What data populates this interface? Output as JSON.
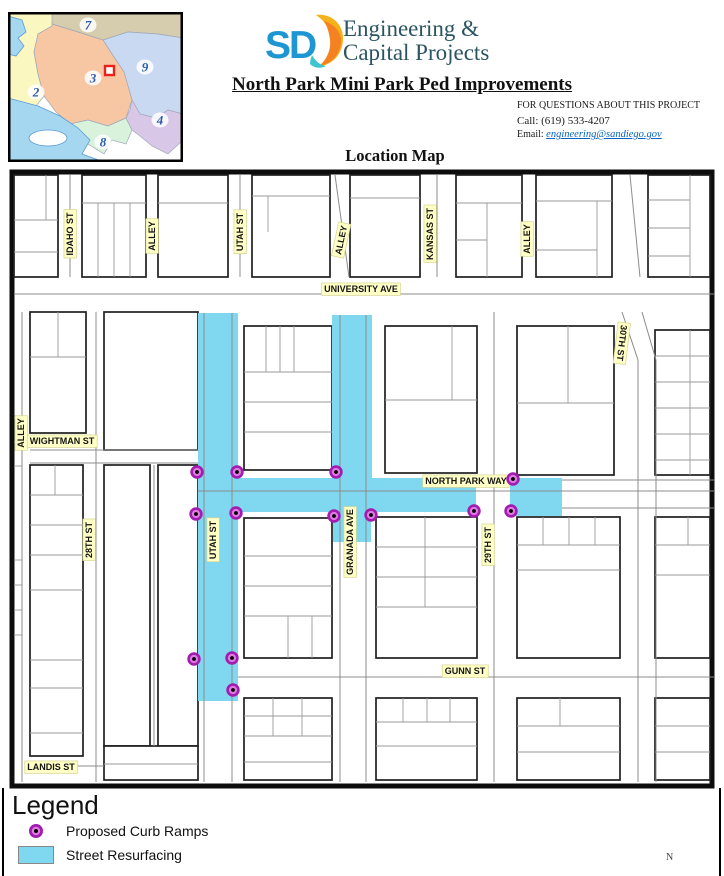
{
  "header": {
    "logo_text": "SD",
    "org_line1": "Engineering &",
    "org_line2": "Capital Projects",
    "title": "North Park Mini Park Ped Improvements",
    "contact": {
      "line1": "FOR QUESTIONS ABOUT THIS PROJECT",
      "call": "Call: (619) 533-4207",
      "email_label": "Email:",
      "email": "engineering@sandiego.gov"
    },
    "map_title": "Location Map"
  },
  "inset": {
    "districts": [
      {
        "n": "2",
        "x": 28,
        "y": 80
      },
      {
        "n": "3",
        "x": 85,
        "y": 66
      },
      {
        "n": "7",
        "x": 80,
        "y": 13
      },
      {
        "n": "9",
        "x": 137,
        "y": 55
      },
      {
        "n": "4",
        "x": 152,
        "y": 108
      },
      {
        "n": "8",
        "x": 95,
        "y": 130
      }
    ]
  },
  "colors": {
    "resurfacing": "#7FD8F0",
    "ramp_ring": "#A21CAF",
    "ramp_fill": "#DE7BE0",
    "label_bg": "#FFFFC6",
    "number_blue": "#2B5BAD",
    "marker_red": "#E8231A"
  },
  "map": {
    "north_label": "N",
    "labels": [
      {
        "text": "IDAHO ST",
        "x": 70,
        "y": 234,
        "rot": -90
      },
      {
        "text": "ALLEY",
        "x": 152,
        "y": 236,
        "rot": -90
      },
      {
        "text": "UTAH ST",
        "x": 240,
        "y": 232,
        "rot": -90
      },
      {
        "text": "ALLEY",
        "x": 341,
        "y": 240,
        "rot": -78
      },
      {
        "text": "KANSAS ST",
        "x": 430,
        "y": 234,
        "rot": -90
      },
      {
        "text": "ALLEY",
        "x": 527,
        "y": 239,
        "rot": -90
      },
      {
        "text": "UNIVERSITY AVE",
        "x": 361,
        "y": 289,
        "rot": 0
      },
      {
        "text": "30TH ST",
        "x": 622,
        "y": 343,
        "rot": 97
      },
      {
        "text": "ALLEY",
        "x": 21,
        "y": 433,
        "rot": -90
      },
      {
        "text": "WIGHTMAN ST",
        "x": 62,
        "y": 441,
        "rot": 0
      },
      {
        "text": "28TH ST",
        "x": 89,
        "y": 540,
        "rot": -90
      },
      {
        "text": "UTAH ST",
        "x": 213,
        "y": 540,
        "rot": -90
      },
      {
        "text": "GRANADA AVE",
        "x": 350,
        "y": 542,
        "rot": -90
      },
      {
        "text": "NORTH PARK WAY",
        "x": 466,
        "y": 481,
        "rot": 0
      },
      {
        "text": "29TH ST",
        "x": 488,
        "y": 545,
        "rot": -90
      },
      {
        "text": "GUNN ST",
        "x": 465,
        "y": 671,
        "rot": 0
      },
      {
        "text": "LANDIS ST",
        "x": 51,
        "y": 767,
        "rot": 0
      }
    ],
    "resurfacing": [
      [
        198,
        313,
        40,
        388
      ],
      [
        332,
        315,
        40,
        163
      ],
      [
        198,
        478,
        278,
        34
      ],
      [
        510,
        478,
        52,
        38
      ],
      [
        333,
        512,
        38,
        30
      ]
    ],
    "curb_ramps": [
      [
        197,
        472
      ],
      [
        237,
        472
      ],
      [
        336,
        472
      ],
      [
        196,
        514
      ],
      [
        236,
        513
      ],
      [
        334,
        516
      ],
      [
        371,
        515
      ],
      [
        474,
        511
      ],
      [
        513,
        479
      ],
      [
        511,
        511
      ],
      [
        194,
        659
      ],
      [
        232,
        658
      ],
      [
        233,
        690
      ]
    ],
    "blocks": [
      [
        14,
        175,
        44,
        102
      ],
      [
        82,
        175,
        64,
        102
      ],
      [
        158,
        175,
        70,
        102
      ],
      [
        252,
        175,
        78,
        102
      ],
      [
        350,
        175,
        70,
        102
      ],
      [
        456,
        175,
        66,
        102
      ],
      [
        536,
        175,
        76,
        102
      ],
      [
        648,
        175,
        62,
        102
      ],
      [
        30,
        312,
        56,
        121
      ],
      [
        104,
        312,
        94,
        138
      ],
      [
        30,
        465,
        53,
        291
      ],
      [
        104,
        465,
        46,
        281
      ],
      [
        158,
        465,
        40,
        281
      ],
      [
        244,
        326,
        88,
        144
      ],
      [
        385,
        326,
        92,
        147
      ],
      [
        517,
        326,
        97,
        149
      ],
      [
        655,
        330,
        55,
        145
      ],
      [
        244,
        518,
        88,
        140
      ],
      [
        376,
        517,
        101,
        141
      ],
      [
        517,
        517,
        103,
        141
      ],
      [
        655,
        517,
        55,
        141
      ],
      [
        244,
        698,
        88,
        82
      ],
      [
        376,
        698,
        101,
        82
      ],
      [
        517,
        698,
        103,
        82
      ],
      [
        655,
        698,
        55,
        82
      ],
      [
        104,
        746,
        94,
        34
      ]
    ],
    "parcel_lines": [
      [
        14,
        220,
        58,
        220
      ],
      [
        14,
        252,
        58,
        252
      ],
      [
        46,
        175,
        46,
        220
      ],
      [
        82,
        203,
        146,
        203
      ],
      [
        98,
        203,
        98,
        277
      ],
      [
        114,
        203,
        114,
        277
      ],
      [
        130,
        203,
        130,
        277
      ],
      [
        158,
        203,
        228,
        203
      ],
      [
        252,
        196,
        330,
        196
      ],
      [
        268,
        196,
        268,
        232
      ],
      [
        350,
        198,
        420,
        198
      ],
      [
        456,
        203,
        522,
        203
      ],
      [
        487,
        203,
        487,
        277
      ],
      [
        456,
        240,
        487,
        240
      ],
      [
        536,
        201,
        612,
        201
      ],
      [
        597,
        201,
        597,
        277
      ],
      [
        536,
        250,
        597,
        250
      ],
      [
        690,
        175,
        690,
        277
      ],
      [
        648,
        200,
        690,
        200
      ],
      [
        648,
        228,
        690,
        228
      ],
      [
        648,
        256,
        690,
        256
      ],
      [
        30,
        357,
        86,
        357
      ],
      [
        58,
        312,
        58,
        357
      ],
      [
        30,
        495,
        83,
        495
      ],
      [
        30,
        525,
        83,
        525
      ],
      [
        30,
        555,
        83,
        555
      ],
      [
        30,
        590,
        83,
        590
      ],
      [
        30,
        660,
        83,
        660
      ],
      [
        30,
        688,
        83,
        688
      ],
      [
        30,
        733,
        83,
        733
      ],
      [
        55,
        465,
        55,
        495
      ],
      [
        244,
        372,
        332,
        372
      ],
      [
        244,
        402,
        332,
        402
      ],
      [
        244,
        432,
        332,
        432
      ],
      [
        266,
        326,
        266,
        372
      ],
      [
        280,
        326,
        280,
        372
      ],
      [
        294,
        326,
        294,
        372
      ],
      [
        385,
        400,
        477,
        400
      ],
      [
        452,
        326,
        452,
        400
      ],
      [
        517,
        403,
        614,
        403
      ],
      [
        568,
        326,
        568,
        403
      ],
      [
        655,
        356,
        710,
        356
      ],
      [
        655,
        382,
        710,
        382
      ],
      [
        655,
        408,
        710,
        408
      ],
      [
        655,
        434,
        710,
        434
      ],
      [
        655,
        460,
        710,
        460
      ],
      [
        690,
        330,
        690,
        475
      ],
      [
        244,
        556,
        332,
        556
      ],
      [
        244,
        586,
        332,
        586
      ],
      [
        244,
        616,
        332,
        616
      ],
      [
        288,
        616,
        288,
        658
      ],
      [
        312,
        616,
        312,
        658
      ],
      [
        376,
        547,
        477,
        547
      ],
      [
        376,
        577,
        477,
        577
      ],
      [
        376,
        607,
        477,
        607
      ],
      [
        425,
        517,
        425,
        607
      ],
      [
        517,
        545,
        620,
        545
      ],
      [
        517,
        570,
        620,
        570
      ],
      [
        543,
        517,
        543,
        545
      ],
      [
        569,
        517,
        569,
        545
      ],
      [
        595,
        517,
        595,
        545
      ],
      [
        655,
        545,
        710,
        545
      ],
      [
        655,
        575,
        710,
        575
      ],
      [
        688,
        517,
        688,
        545
      ],
      [
        244,
        716,
        332,
        716
      ],
      [
        244,
        736,
        332,
        736
      ],
      [
        273,
        698,
        273,
        736
      ],
      [
        302,
        698,
        302,
        736
      ],
      [
        244,
        762,
        332,
        762
      ],
      [
        376,
        722,
        477,
        722
      ],
      [
        376,
        746,
        477,
        746
      ],
      [
        403,
        698,
        403,
        722
      ],
      [
        427,
        698,
        427,
        722
      ],
      [
        450,
        698,
        450,
        722
      ],
      [
        517,
        726,
        620,
        726
      ],
      [
        517,
        752,
        620,
        752
      ],
      [
        560,
        698,
        560,
        726
      ],
      [
        655,
        726,
        710,
        726
      ],
      [
        655,
        752,
        710,
        752
      ],
      [
        104,
        764,
        198,
        764
      ],
      [
        14,
        418,
        22,
        418
      ],
      [
        14,
        442,
        22,
        442
      ],
      [
        14,
        466,
        22,
        466
      ],
      [
        14,
        560,
        22,
        560
      ],
      [
        14,
        585,
        22,
        585
      ],
      [
        14,
        610,
        22,
        610
      ],
      [
        14,
        635,
        22,
        635
      ]
    ],
    "street_lines": [
      [
        204,
        313,
        204,
        782
      ],
      [
        232,
        313,
        232,
        782
      ],
      [
        340,
        315,
        340,
        782
      ],
      [
        366,
        315,
        366,
        782
      ],
      [
        198,
        491,
        714,
        491
      ],
      [
        562,
        480,
        714,
        480
      ],
      [
        562,
        508,
        714,
        508
      ],
      [
        238,
        677,
        714,
        677
      ],
      [
        30,
        450,
        198,
        450
      ],
      [
        30,
        463,
        198,
        463
      ],
      [
        14,
        294,
        714,
        294
      ],
      [
        30,
        766,
        104,
        766
      ],
      [
        494,
        312,
        494,
        782
      ],
      [
        96,
        312,
        96,
        782
      ],
      [
        22,
        312,
        22,
        782
      ],
      [
        154,
        465,
        154,
        746
      ],
      [
        638,
        360,
        638,
        782
      ],
      [
        656,
        360,
        656,
        782
      ],
      [
        622,
        312,
        638,
        360
      ],
      [
        642,
        312,
        656,
        360
      ],
      [
        630,
        175,
        640,
        277
      ],
      [
        335,
        175,
        349,
        277
      ],
      [
        437,
        175,
        437,
        277
      ],
      [
        70,
        175,
        70,
        277
      ],
      [
        240,
        175,
        240,
        277
      ]
    ]
  },
  "legend": {
    "title": "Legend",
    "items": [
      {
        "label": "Proposed Curb Ramps"
      },
      {
        "label": "Street Resurfacing"
      }
    ]
  }
}
